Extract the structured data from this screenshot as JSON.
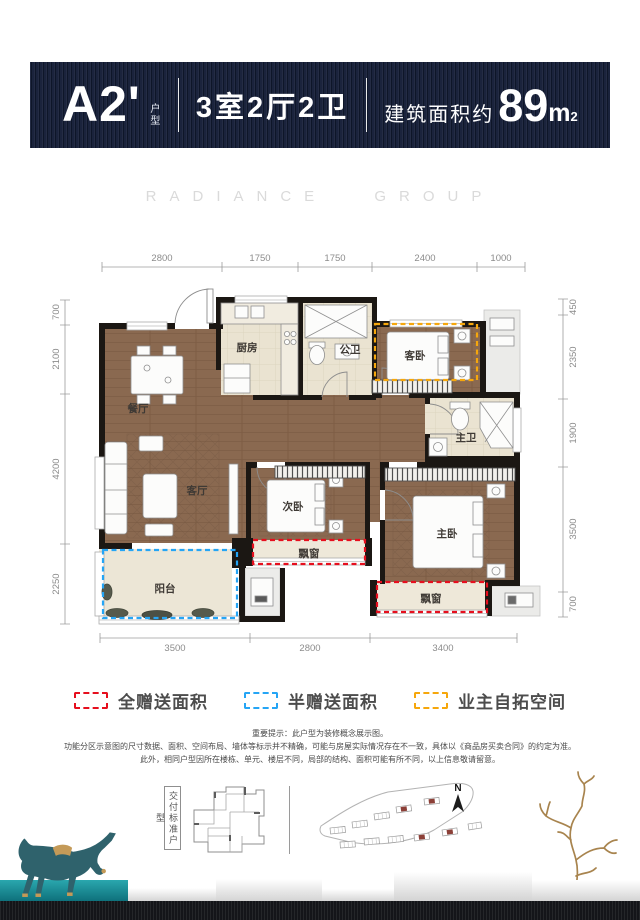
{
  "header": {
    "unit_code": "A2'",
    "unit_type_label": "户型",
    "layout_summary": "3室2厅2卫",
    "area_prefix": "建筑面积约",
    "area_value": "89",
    "area_unit": "m",
    "area_superscript": "2"
  },
  "watermark": "RADIANCE GROUP",
  "floor_plan": {
    "rooms": {
      "dining": "餐厅",
      "kitchen": "厨房",
      "public_bath": "公卫",
      "guest_bedroom": "客卧",
      "master_bath": "主卫",
      "living": "客厅",
      "second_bedroom": "次卧",
      "master_bedroom": "主卧",
      "balcony": "阳台",
      "bay_window": "飘窗"
    },
    "dimensions": {
      "top": [
        "2800",
        "1750",
        "1750",
        "2400",
        "1000"
      ],
      "bottom": [
        "3500",
        "2800",
        "3400"
      ],
      "left": [
        "700",
        "2100",
        "4200",
        "2250"
      ],
      "right": [
        "450",
        "2350",
        "1900",
        "3500",
        "700"
      ]
    }
  },
  "legend": {
    "items": [
      {
        "label": "全赠送面积",
        "color": "#e60f1e"
      },
      {
        "label": "半赠送面积",
        "color": "#25a5f5"
      },
      {
        "label": "业主自拓空间",
        "color": "#f6a70c"
      }
    ]
  },
  "disclaimer": {
    "line1": "重要提示：此户型为装修概念展示图。",
    "line2": "功能分区示意图的尺寸数据、面积、空间布局、墙体等标示并不精确，可能与房屋实际情况存在不一致，具体以《商品房买卖合同》的约定为准。",
    "line3": "此外，相同户型因所在楼栋、单元、楼层不同，局部的结构、面积可能有所不同，以上信息敬请留意。"
  },
  "footer": {
    "delivery_label": "交付标准户型",
    "compass_label": "N"
  }
}
